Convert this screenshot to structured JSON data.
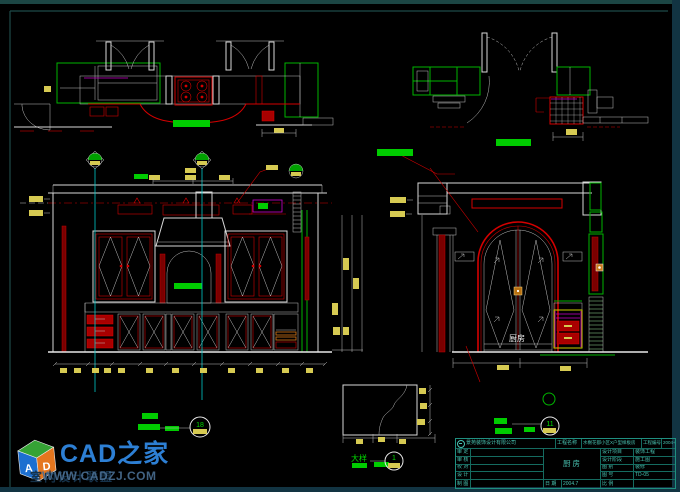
{
  "canvas": {
    "width": 680,
    "height": 492,
    "background": "#000000"
  },
  "palette": {
    "line_white": "#d9d9d9",
    "line_red": "#d40000",
    "fill_dark_red": "#7a0000",
    "line_green": "#00b400",
    "bar_green": "#00cc00",
    "line_cyan": "#00c8c8",
    "text_yellow": "#d6ca52",
    "line_magenta": "#cc00cc",
    "accent_orange": "#c87818",
    "frame_teal": "#1c4644",
    "frame_band": "#123442",
    "titleblock_green": "#1f8f80",
    "titleblock_text": "#49c2b1",
    "brand_blue": "#2d7fd4",
    "url_gray_blue": "#4a6e92"
  },
  "annotations": {
    "door_label": "厨房",
    "detail_label": "大样",
    "detail_number": "1",
    "marker_left": "18",
    "marker_right": "11"
  },
  "title_block": {
    "company": "景苑装饰设计有限公司",
    "project_label": "工程名称",
    "project_name": "水榭花都小区X户型样板房",
    "number_label": "工程编号",
    "number_value": "2004-05",
    "drawing_name": "厨房",
    "rows_left": [
      {
        "label": "审 定",
        "value": ""
      },
      {
        "label": "审 核",
        "value": ""
      },
      {
        "label": "校 对",
        "value": ""
      },
      {
        "label": "设 计",
        "value": ""
      },
      {
        "label": "制 图",
        "value": ""
      }
    ],
    "rows_right": [
      {
        "label": "设计项目",
        "value": "装饰工程"
      },
      {
        "label": "设计阶段",
        "value": "施工图"
      },
      {
        "label": "图 别",
        "value": "装修"
      },
      {
        "label": "图 号",
        "value": "TD-05"
      },
      {
        "label": "比 例",
        "value": ""
      }
    ],
    "bottom": {
      "date_label": "日 期",
      "date_value": "2004.7"
    }
  },
  "watermark": {
    "brand": "CAD之家",
    "url": "WWW.CADZJ.COM",
    "alliance": "室内设计联盟",
    "cube_letters": [
      "A",
      "D"
    ]
  }
}
